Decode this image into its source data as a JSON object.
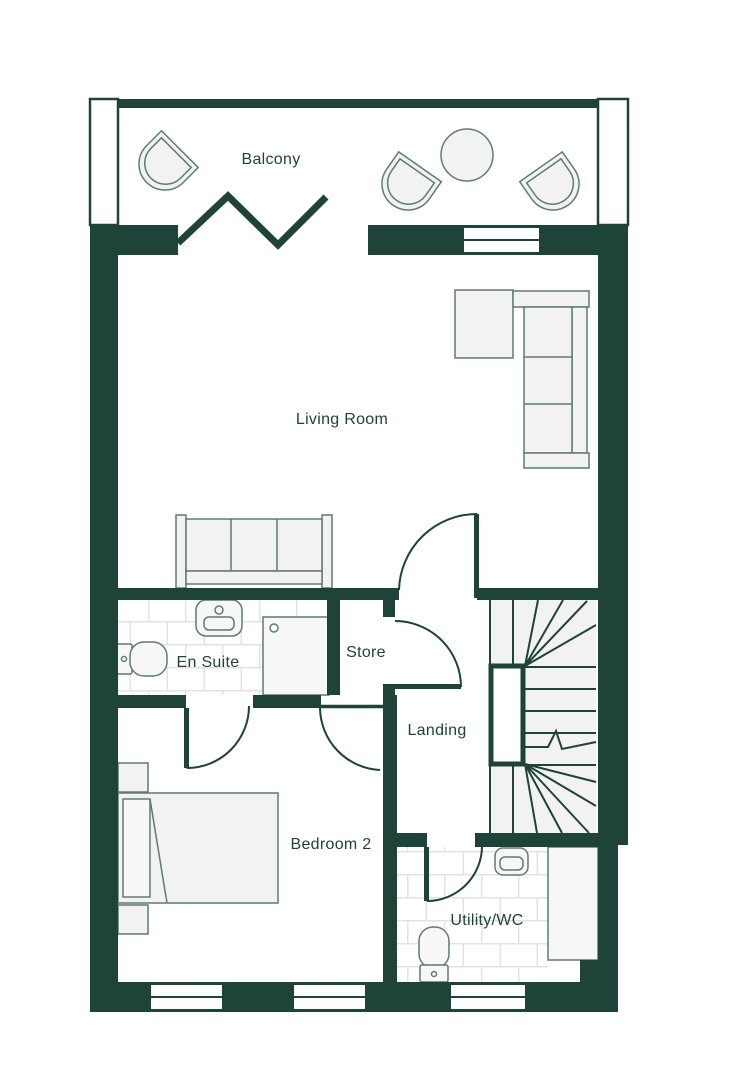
{
  "page": {
    "type": "floor-plan",
    "background": "#ffffff"
  },
  "colors": {
    "wall": "#1e4338",
    "furniture_outline": "#5d7c72",
    "furniture_fill": "#f2f2f1",
    "tile_grout": "#e3e3e2",
    "label_text": "#1e4338"
  },
  "rooms": {
    "balcony": {
      "label": "Balcony"
    },
    "living_room": {
      "label": "Living Room"
    },
    "en_suite": {
      "label": "En Suite"
    },
    "store": {
      "label": "Store"
    },
    "landing": {
      "label": "Landing"
    },
    "bedroom_2": {
      "label": "Bedroom 2"
    },
    "utility_wc": {
      "label": "Utility/WC"
    }
  },
  "fixtures": [
    "balcony-tub-chair",
    "balcony-tub-chair",
    "balcony-tub-chair",
    "balcony-round-table",
    "bifold-balcony-door",
    "corner-sofa",
    "sofa",
    "window-seat",
    "double-bed",
    "bedside-table",
    "bedside-table",
    "shower",
    "basin",
    "toilet",
    "basin",
    "toilet",
    "winder-staircase",
    "utility-counter"
  ]
}
